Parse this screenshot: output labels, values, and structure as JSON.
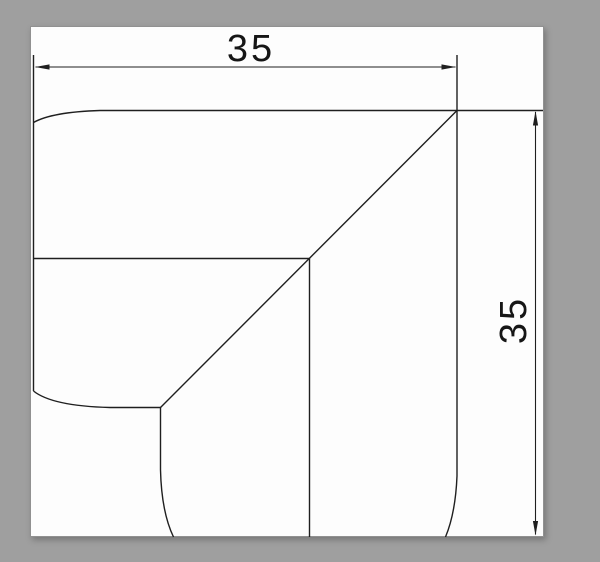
{
  "drawing": {
    "type": "technical-cad-drawing",
    "subject": "flat corner piece, mitered 90-degree elbow",
    "dimension_labels": {
      "horizontal": "35",
      "vertical": "35"
    }
  },
  "colors": {
    "background_gray": "#9f9f9f",
    "paper_white": "#fdfdfd",
    "line_color": "#1f1f1f",
    "text_color": "#161616"
  }
}
